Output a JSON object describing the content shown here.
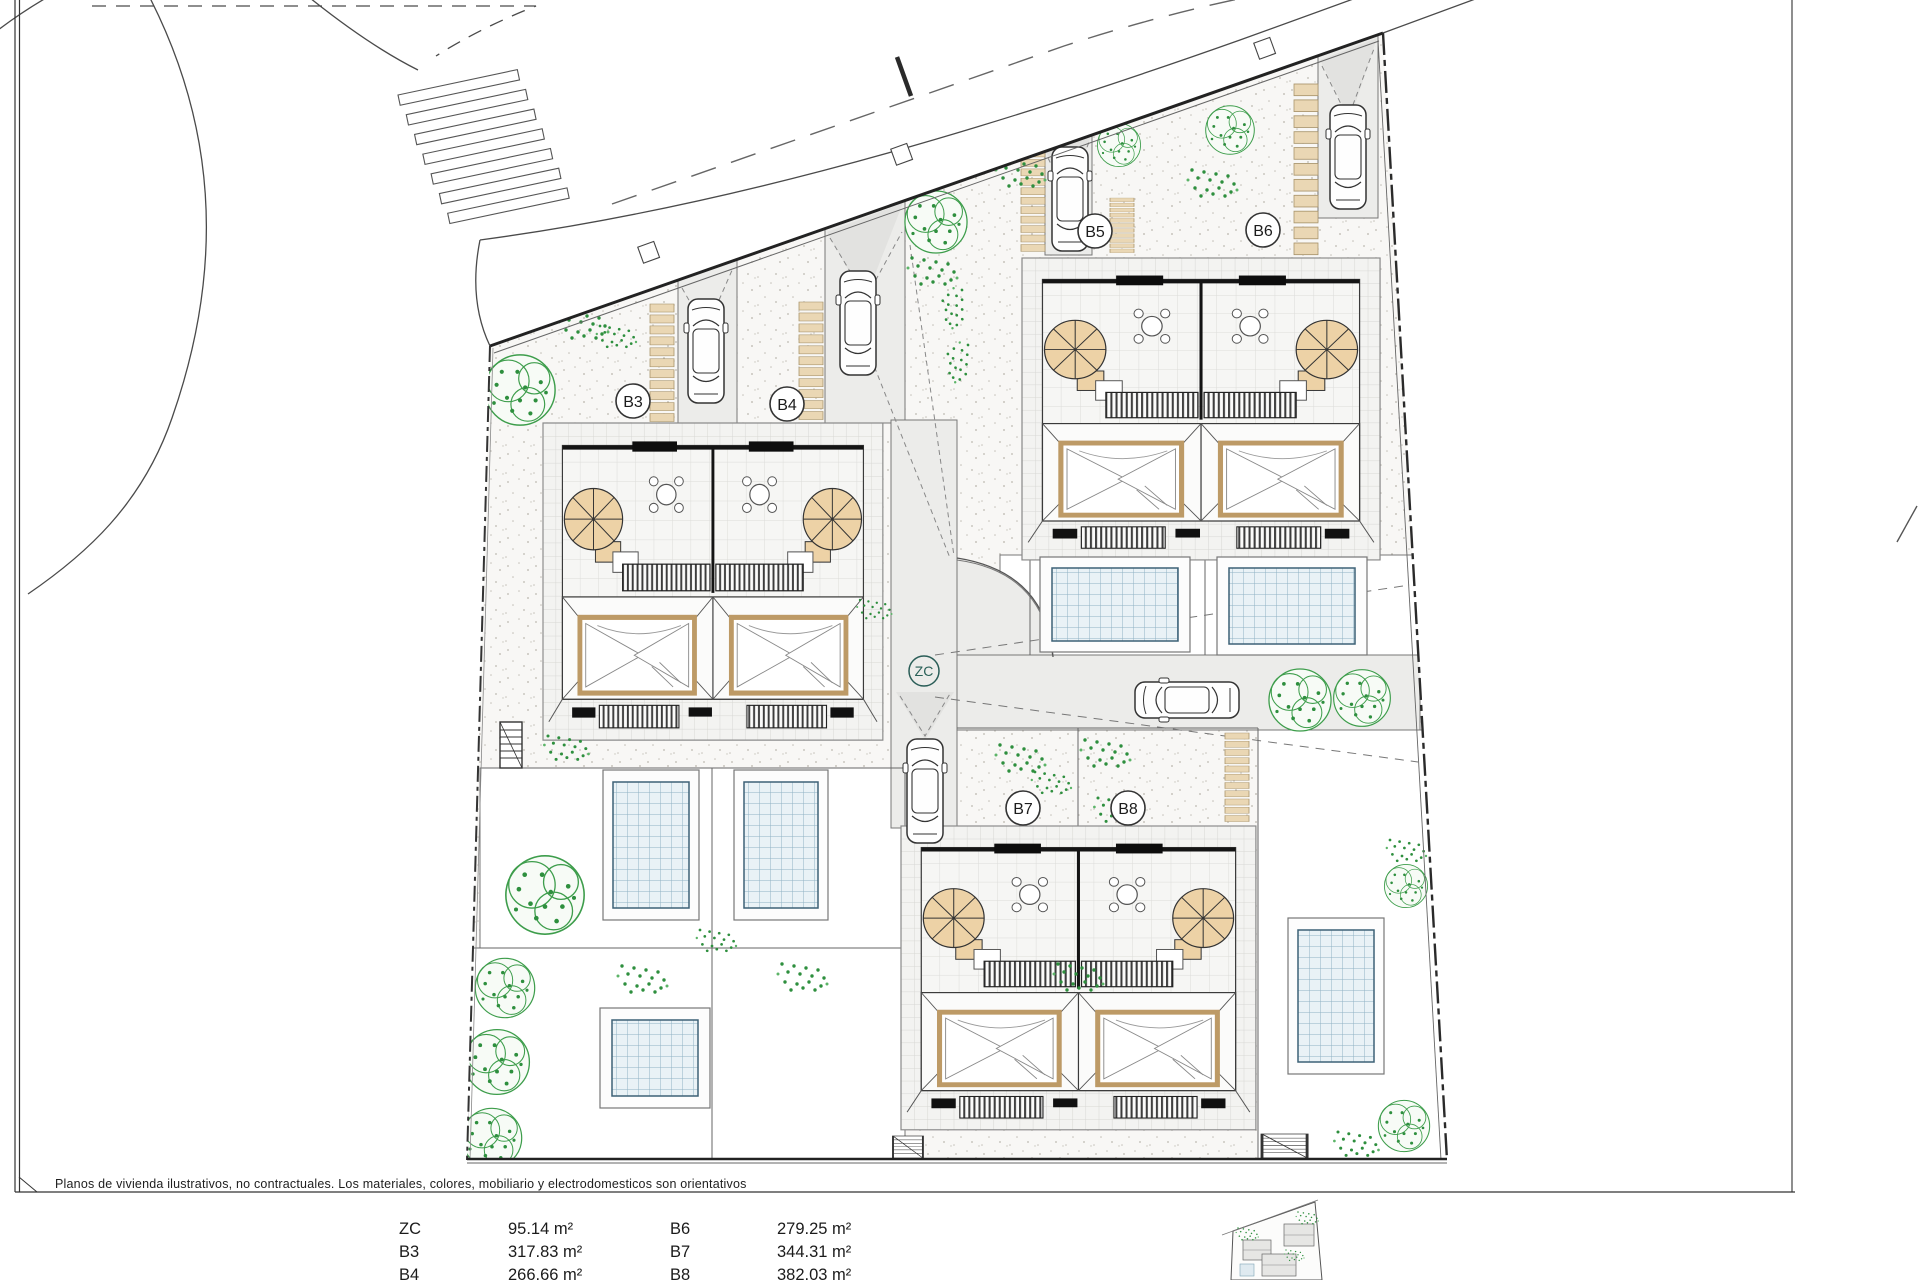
{
  "footer": {
    "note": "Planos de vivienda ilustrativos, no contractuales. Los materiales, colores, mobiliario y electrodomesticos son orientativos"
  },
  "legend": {
    "rows": [
      {
        "code1": "ZC",
        "area1": "95.14 m²",
        "code2": "B6",
        "area2": "279.25 m²"
      },
      {
        "code1": "B3",
        "area1": "317.83 m²",
        "code2": "B7",
        "area2": "344.31 m²"
      },
      {
        "code1": "B4",
        "area1": "266.66 m²",
        "code2": "B8",
        "area2": "382.03 m²"
      }
    ]
  },
  "plan": {
    "unit_labels": {
      "b3": "B3",
      "b4": "B4",
      "b5": "B5",
      "b6": "B6",
      "b7": "B7",
      "b8": "B8",
      "zc": "ZC"
    },
    "colors": {
      "tree_green": "#2e8f3e",
      "stone_tan": "#ead7b4",
      "stair_tan": "#edd2a6",
      "pool_line_blue": "#8fb2c4",
      "line_dark": "#3a3a3a"
    }
  }
}
